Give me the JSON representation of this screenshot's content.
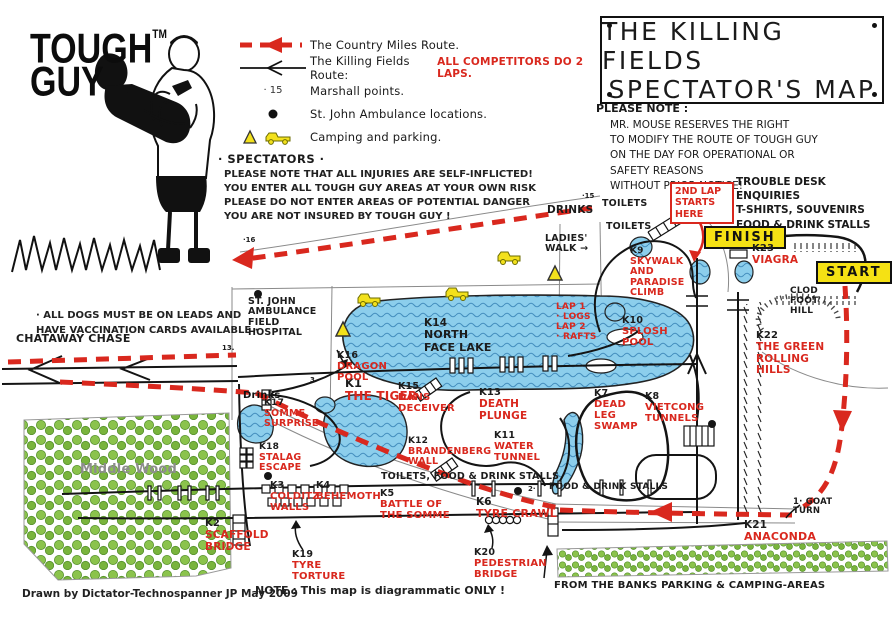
{
  "colors": {
    "accent_red": "#d9281e",
    "water": "#8cceec",
    "trees": "#82bd46",
    "highlight": "#f5e114"
  },
  "logo": {
    "line1": "TOUGH",
    "tm": "TM",
    "line2": "GUY"
  },
  "legend": {
    "items": [
      {
        "icon": "country-miles-route-icon",
        "label": "The Country Miles Route."
      },
      {
        "icon": "killing-fields-route-icon",
        "label": "The Killing Fields Route:",
        "label_red": "ALL COMPETITORS DO 2 LAPS."
      },
      {
        "icon": "marshall-point-icon",
        "icon_text": "· 15",
        "label": "Marshall points."
      },
      {
        "icon": "ambulance-dot-icon",
        "label": "St. John Ambulance locations."
      },
      {
        "icon": "camping-parking-icon",
        "label": "Camping and parking."
      }
    ]
  },
  "title_box": {
    "line1": "THE KILLING FIELDS",
    "line2": "SPECTATOR'S MAP"
  },
  "please_note": {
    "heading": "PLEASE NOTE :",
    "lines": [
      "MR. MOUSE RESERVES THE RIGHT",
      "TO MODIFY THE ROUTE OF TOUGH GUY",
      "ON THE DAY FOR OPERATIONAL OR",
      "SAFETY REASONS",
      "WITHOUT PRIOR NOTICE!"
    ]
  },
  "trouble_desk": {
    "lines": [
      "TROUBLE DESK",
      "ENQUIRIES",
      "T-SHIRTS, SOUVENIRS",
      "FOOD & DRINK STALLS"
    ]
  },
  "spectators": {
    "heading": "· SPECTATORS ·",
    "lines": [
      "PLEASE NOTE THAT ALL INJURIES ARE SELF-INFLICTED!",
      "YOU ENTER ALL TOUGH GUY AREAS AT YOUR OWN RISK",
      "PLEASE DO NOT ENTER AREAS OF POTENTIAL DANGER",
      "YOU ARE NOT INSURED BY TOUGH GUY !"
    ]
  },
  "dogs_note": {
    "lines": [
      "· ALL DOGS MUST BE ON LEADS AND",
      "HAVE VACCINATION CARDS AVAILABLE ·"
    ]
  },
  "credits": {
    "drawn_by": "Drawn by Dictator-Technospanner JP  May 2009",
    "note": "NOTE : This map is diagrammatic ONLY !"
  },
  "badges": {
    "finish": "FINISH",
    "start": "START",
    "second_lap": "2ND LAP\nSTARTS\nHERE"
  },
  "map": {
    "labels": [
      {
        "n": "k1-the-tiger",
        "num": "K1",
        "text": "THE TIGER",
        "x": 345,
        "y": 377,
        "cls": "red",
        "fs": 12
      },
      {
        "n": "k2-scaffold-bridge",
        "num": "K2",
        "text": "SCAFFOLD\nBRIDGE",
        "x": 205,
        "y": 519,
        "cls": "red",
        "fs": 10.5
      },
      {
        "n": "k3-colditz-walls",
        "num": "K3",
        "text": "COLDITZ\nWALLS",
        "x": 270,
        "y": 481,
        "cls": "red",
        "fs": 10
      },
      {
        "n": "k4-behemoth",
        "num": "K4",
        "text": "BEHEMOTH",
        "x": 316,
        "y": 481,
        "cls": "red",
        "fs": 10
      },
      {
        "n": "k5-battle-of-the-somme",
        "num": "K5",
        "text": "BATTLE OF\nTHE SOMME",
        "x": 380,
        "y": 489,
        "cls": "red",
        "fs": 10
      },
      {
        "n": "k6-tyre-crawl",
        "num": "K6",
        "text": "TYRE CRAWL",
        "x": 476,
        "y": 497,
        "cls": "red",
        "fs": 11
      },
      {
        "n": "k7-dead-leg-swamp",
        "num": "K7",
        "text": "DEAD\nLEG\nSWAMP",
        "x": 594,
        "y": 389,
        "cls": "red",
        "fs": 10
      },
      {
        "n": "k8-vietcong-tunnels",
        "num": "K8",
        "text": "VIETCONG\nTUNNELS",
        "x": 645,
        "y": 392,
        "cls": "red",
        "fs": 10
      },
      {
        "n": "k9-skywalk-paradise-climb",
        "num": "K9",
        "text": "SKYWALK\nAND\nPARADISE\nCLIMB",
        "x": 630,
        "y": 247,
        "cls": "red",
        "fs": 9.5
      },
      {
        "n": "k10-splosh-pool",
        "num": "K10",
        "text": "SPLOSH\nPOOL",
        "x": 622,
        "y": 316,
        "cls": "red",
        "fs": 10
      },
      {
        "n": "k11-water-tunnel",
        "num": "K11",
        "text": "WATER\nTUNNEL",
        "x": 494,
        "y": 431,
        "cls": "red",
        "fs": 10
      },
      {
        "n": "k12-brandenberg-wall",
        "num": "K12",
        "text": "BRANDENBERG\nWALL",
        "x": 408,
        "y": 437,
        "cls": "red",
        "fs": 9.5
      },
      {
        "n": "k13-death-plunge",
        "num": "K13",
        "text": "DEATH\nPLUNGE",
        "x": 479,
        "y": 388,
        "cls": "red",
        "fs": 10.5
      },
      {
        "n": "k14-north-face-lake",
        "num": "K14",
        "text": "NORTH\nFACE LAKE",
        "x": 424,
        "y": 318,
        "cls": "black",
        "fs": 11
      },
      {
        "n": "k15-dans-deceiver",
        "num": "K15",
        "text": "DANS\nDECEIVER",
        "x": 398,
        "y": 382,
        "cls": "red",
        "fs": 10
      },
      {
        "n": "k16-dragon-pool",
        "num": "K16",
        "text": "DRAGON\nPOOL",
        "x": 337,
        "y": 351,
        "cls": "red",
        "fs": 10
      },
      {
        "n": "k17-somme-surprise",
        "num": "K17",
        "text": "SOMME\nSURPRISE",
        "x": 264,
        "y": 399,
        "cls": "red",
        "fs": 9.5
      },
      {
        "n": "k18-stalag-escape",
        "num": "K18",
        "text": "STALAG\nESCAPE",
        "x": 259,
        "y": 443,
        "cls": "red",
        "fs": 9.5
      },
      {
        "n": "k19-tyre-torture",
        "num": "K19",
        "text": "TYRE\nTORTURE",
        "x": 292,
        "y": 550,
        "cls": "red",
        "fs": 10
      },
      {
        "n": "k20-pedestrian-bridge",
        "num": "K20",
        "text": "PEDESTRIAN\nBRIDGE",
        "x": 474,
        "y": 548,
        "cls": "red",
        "fs": 10
      },
      {
        "n": "k21-anaconda",
        "num": "K21",
        "text": "ANACONDA",
        "x": 744,
        "y": 520,
        "cls": "red",
        "fs": 11
      },
      {
        "n": "k22-green-rolling-hills",
        "num": "K22",
        "text": "THE GREEN\nROLLING\nHILLS",
        "x": 756,
        "y": 331,
        "cls": "red",
        "fs": 10.5
      },
      {
        "n": "k23-viagra",
        "num": "K23",
        "text": "VIAGRA",
        "x": 752,
        "y": 244,
        "cls": "red",
        "fs": 10.5
      },
      {
        "n": "lap-info",
        "text": "LAP 1\n· LOGS\nLAP 2\n· RAFTS",
        "x": 556,
        "y": 303,
        "cls": "red",
        "fs": 9
      },
      {
        "n": "chataway-chase",
        "text": "CHATAWAY CHASE",
        "x": 16,
        "y": 333,
        "cls": "black",
        "fs": 11
      },
      {
        "n": "middle-wood",
        "text": "Middle Wood",
        "x": 80,
        "y": 463,
        "cls": "grey",
        "fs": 13
      },
      {
        "n": "field-hospital",
        "text": "ST. JOHN\nAMBULANCE\nFIELD\nHOSPITAL",
        "x": 248,
        "y": 297,
        "cls": "black",
        "fs": 9.5
      },
      {
        "n": "drinks-station",
        "text": "Drinks",
        "x": 243,
        "y": 390,
        "cls": "boldb",
        "fs": 10
      },
      {
        "n": "drinks-top",
        "text": "DRINKS",
        "x": 547,
        "y": 205,
        "cls": "black",
        "fs": 10.5
      },
      {
        "n": "toilets-1",
        "text": "TOILETS",
        "x": 602,
        "y": 199,
        "cls": "black",
        "fs": 9.5
      },
      {
        "n": "toilets-2",
        "text": "TOILETS",
        "x": 606,
        "y": 222,
        "cls": "black",
        "fs": 9.5
      },
      {
        "n": "ladies-walk",
        "text": "LADIES'\nWALK →",
        "x": 545,
        "y": 234,
        "cls": "black",
        "fs": 9.5
      },
      {
        "n": "clod-foot-hill",
        "text": "CLOD\nFOOT\nHILL",
        "x": 790,
        "y": 287,
        "cls": "black",
        "fs": 9
      },
      {
        "n": "goat-turn",
        "text": "1· GOAT\n    TURN",
        "x": 793,
        "y": 498,
        "cls": "black",
        "fs": 8.5
      },
      {
        "n": "toilets-food-drink-stalls",
        "text": "TOILETS, FOOD & DRINK STALLS",
        "x": 381,
        "y": 472,
        "cls": "black",
        "fs": 9.5
      },
      {
        "n": "food-drink-stalls",
        "text": "FOOD & DRINK STALLS",
        "x": 549,
        "y": 483,
        "cls": "black",
        "fs": 9
      },
      {
        "n": "from-the-banks",
        "text": "FROM THE BANKS PARKING & CAMPING-AREAS",
        "x": 554,
        "y": 580,
        "cls": "black",
        "fs": 10
      },
      {
        "n": "marshall-16",
        "text": "·16",
        "x": 243,
        "y": 237,
        "cls": "black tiny",
        "fs": 7
      },
      {
        "n": "marshall-13",
        "text": "13.",
        "x": 222,
        "y": 345,
        "cls": "black tiny",
        "fs": 7
      },
      {
        "n": "marshall-15",
        "text": "·15",
        "x": 582,
        "y": 193,
        "cls": "black tiny",
        "fs": 7
      },
      {
        "n": "marshall-2",
        "text": "2·",
        "x": 528,
        "y": 486,
        "cls": "black tiny",
        "fs": 7
      },
      {
        "n": "marshall-3",
        "text": "3",
        "x": 310,
        "y": 377,
        "cls": "black tiny",
        "fs": 7
      }
    ]
  }
}
